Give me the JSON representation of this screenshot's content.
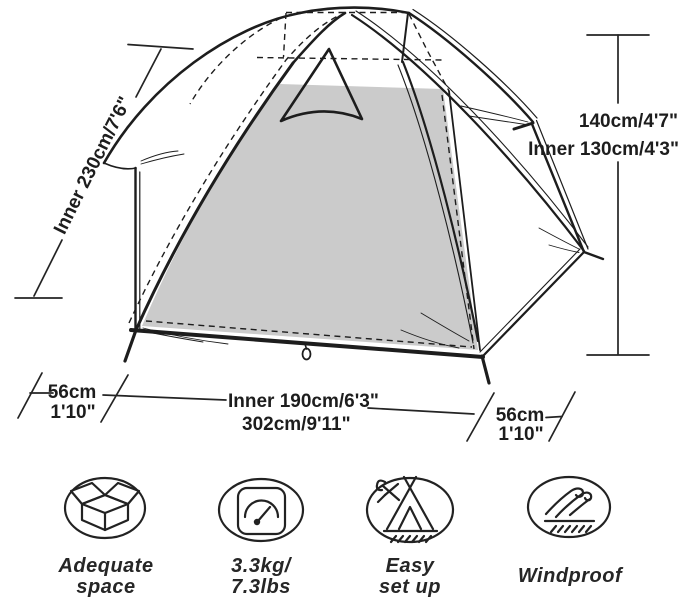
{
  "diagram": {
    "labels": {
      "slant": "Inner 230cm/7'6\"",
      "height": "140cm/4'7\"",
      "inner_height": "Inner 130cm/4'3\"",
      "vestibule_left_cm": "56cm",
      "vestibule_left_ft": "1'10\"",
      "inner_width": "Inner 190cm/6'3\"",
      "total_width": "302cm/9'11\"",
      "vestibule_right_cm": "56cm",
      "vestibule_right_ft": "1'10\""
    }
  },
  "features": [
    {
      "icon": "open-box-icon",
      "line1": "Adequate",
      "line2": "space"
    },
    {
      "icon": "weight-scale-icon",
      "line1": "3.3kg/",
      "line2": "7.3lbs"
    },
    {
      "icon": "tent-setup-icon",
      "line1": "Easy",
      "line2": "set up"
    },
    {
      "icon": "wind-icon",
      "line1": "Windproof",
      "line2": ""
    }
  ],
  "colors": {
    "ink": "#1d1d1d",
    "floor": "#cbcbcb",
    "background": "#ffffff"
  }
}
